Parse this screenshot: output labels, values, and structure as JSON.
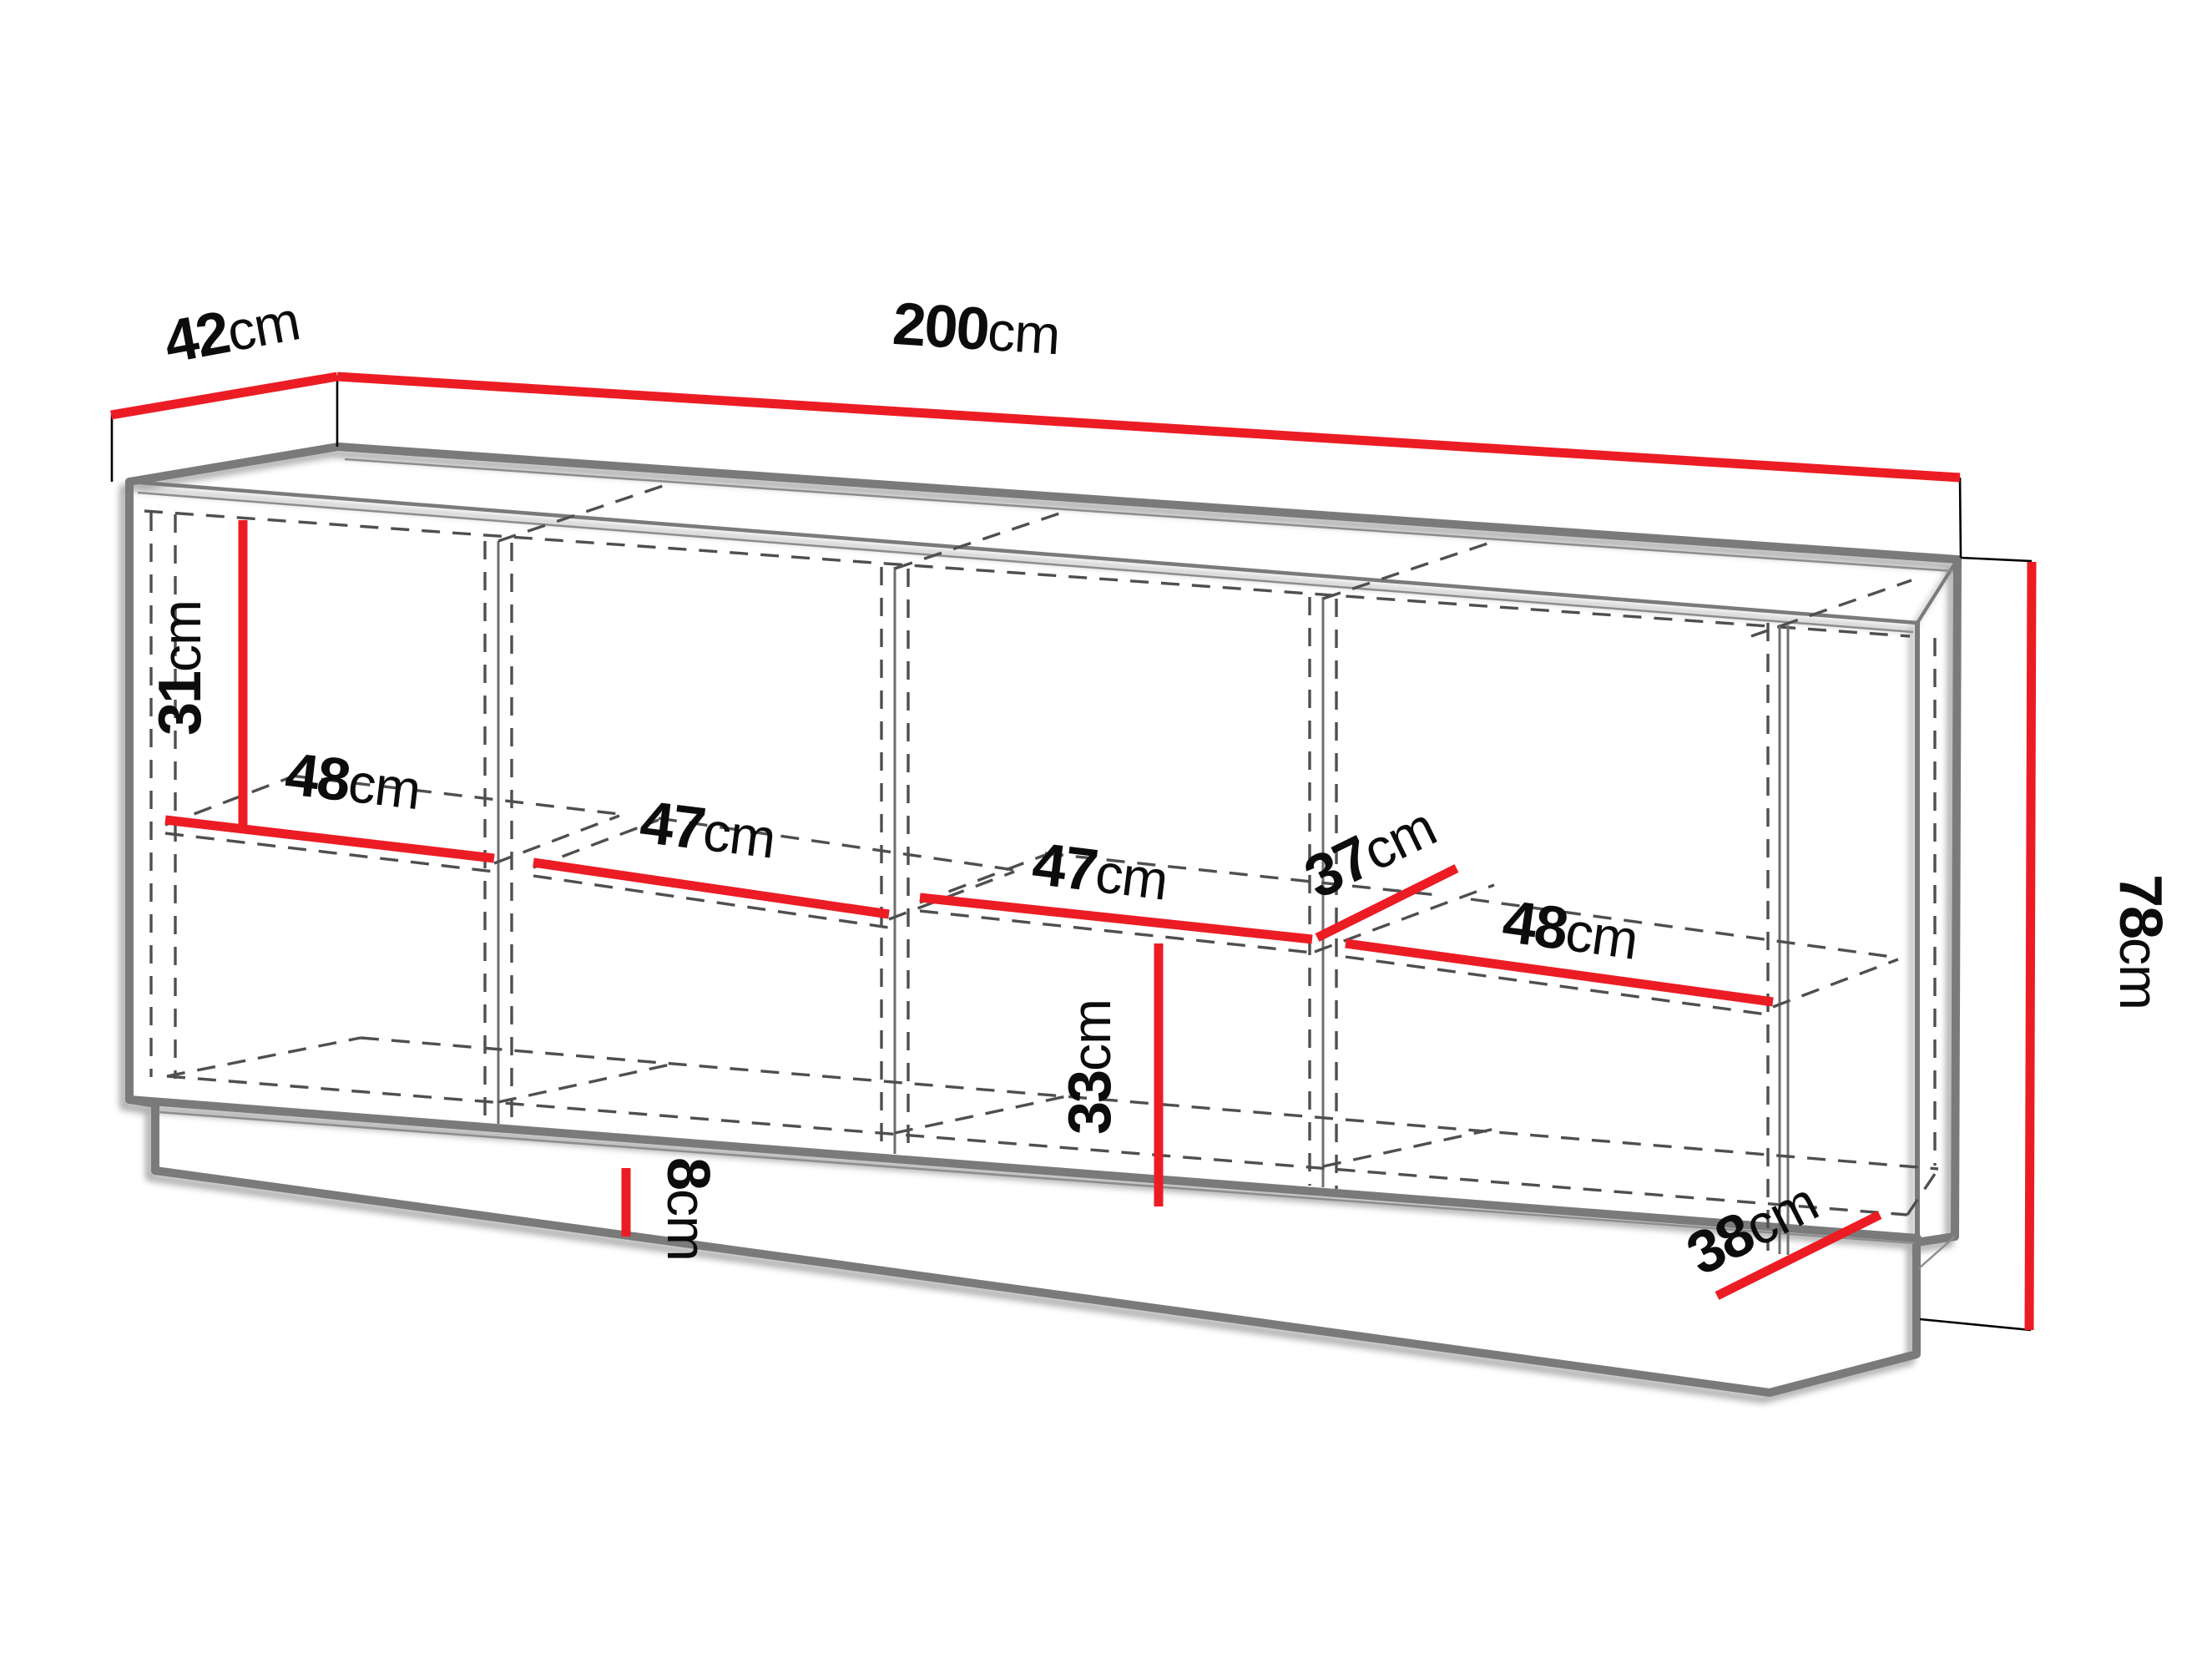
{
  "diagram": {
    "unit": "cm",
    "colors": {
      "dimension_line": "#ec1c24",
      "outline": "#7a7a7a",
      "hidden_line": "#4f4f4f",
      "label_text": "#0c0c0c",
      "background": "#ffffff"
    },
    "dims": {
      "d42": {
        "value": "42",
        "unit": "cm",
        "description": "top depth"
      },
      "d200": {
        "value": "200",
        "unit": "cm",
        "description": "total width"
      },
      "d78": {
        "value": "78",
        "unit": "cm",
        "description": "total height"
      },
      "d31": {
        "value": "31",
        "unit": "cm",
        "description": "upper compartment height"
      },
      "d48a": {
        "value": "48",
        "unit": "cm",
        "description": "compartment 1 shelf width"
      },
      "d47a": {
        "value": "47",
        "unit": "cm",
        "description": "compartment 2 shelf width"
      },
      "d47b": {
        "value": "47",
        "unit": "cm",
        "description": "compartment 3 shelf width"
      },
      "d37": {
        "value": "37",
        "unit": "cm",
        "description": "interior shelf depth"
      },
      "d48b": {
        "value": "48",
        "unit": "cm",
        "description": "compartment 4 shelf width"
      },
      "d33": {
        "value": "33",
        "unit": "cm",
        "description": "lower compartment height"
      },
      "d8": {
        "value": "8",
        "unit": "cm",
        "description": "plinth height"
      },
      "d38": {
        "value": "38",
        "unit": "cm",
        "description": "base depth"
      }
    }
  }
}
